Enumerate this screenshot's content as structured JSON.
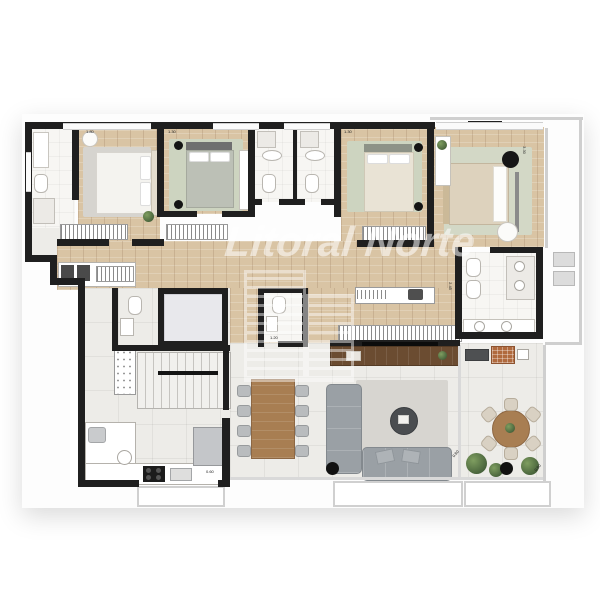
{
  "watermark": {
    "text": "Litoral Norte",
    "logo": "building-outline-icon"
  },
  "dimension_labels": [
    {
      "text": "1.80"
    },
    {
      "text": "1.30"
    },
    {
      "text": "1.30"
    },
    {
      "text": "3.30"
    },
    {
      "text": "2.45"
    },
    {
      "text": "1.20"
    },
    {
      "text": "0.60"
    },
    {
      "text": "0.80"
    },
    {
      "text": "0.80"
    }
  ],
  "rooms": [
    {
      "name": "master-bathroom",
      "furniture": [
        "vanity-sink",
        "toilet",
        "shower"
      ]
    },
    {
      "name": "master-bedroom",
      "furniture": [
        "double-bed",
        "rug",
        "pouf",
        "plant",
        "wardrobe"
      ]
    },
    {
      "name": "bedroom-2",
      "furniture": [
        "double-bed",
        "rug",
        "bedside-lamps",
        "desk",
        "wardrobe"
      ]
    },
    {
      "name": "bathroom-2",
      "furniture": [
        "shower",
        "sink",
        "toilet"
      ]
    },
    {
      "name": "bathroom-3",
      "furniture": [
        "shower",
        "sink",
        "toilet"
      ]
    },
    {
      "name": "bedroom-3",
      "furniture": [
        "double-bed",
        "rug",
        "bedside-lamps",
        "wardrobe"
      ]
    },
    {
      "name": "bedroom-4-suite",
      "furniture": [
        "double-bed",
        "rug",
        "desk-chair",
        "armchair",
        "plant-shelf"
      ]
    },
    {
      "name": "suite-bathroom",
      "furniture": [
        "toilet",
        "bidet",
        "double-shower",
        "twin-vanity"
      ]
    },
    {
      "name": "hallway",
      "furniture": [
        "wardrobes",
        "laundry-counter",
        "cabinet"
      ]
    },
    {
      "name": "wc",
      "furniture": [
        "toilet",
        "sink"
      ]
    },
    {
      "name": "elevator",
      "furniture": []
    },
    {
      "name": "stairs",
      "furniture": []
    },
    {
      "name": "lavabo",
      "furniture": [
        "toilet",
        "sink"
      ]
    },
    {
      "name": "kitchen",
      "furniture": [
        "l-counter",
        "cooktop",
        "sink",
        "fridge",
        "pantry-rack"
      ]
    },
    {
      "name": "dining-area",
      "furniture": [
        "table-8-chairs"
      ]
    },
    {
      "name": "living-room",
      "furniture": [
        "tv-console",
        "tv",
        "chaise-sofa",
        "sofa",
        "coffee-table",
        "rug"
      ]
    },
    {
      "name": "terrace",
      "furniture": [
        "bbq-grill",
        "counter",
        "round-table-6-chairs",
        "plants"
      ]
    },
    {
      "name": "service-balcony",
      "furniture": [
        "ac-units"
      ]
    }
  ],
  "palette": {
    "wall": "#1f1f1f",
    "wood_floor": "#d9c4a4",
    "tile_floor": "#edece8",
    "bath_floor": "#f7f6f3",
    "rug_gray": "#d6d4cf",
    "rug_sage": "#cdd4c0",
    "sofa_gray": "#9aa0a5",
    "dining_wood": "#a87e52",
    "tv_console_wood": "#6b4c31",
    "railing": "#d0d0d0",
    "plant_green": "#4e6b3c",
    "grill_brick": "#b06a3e"
  }
}
